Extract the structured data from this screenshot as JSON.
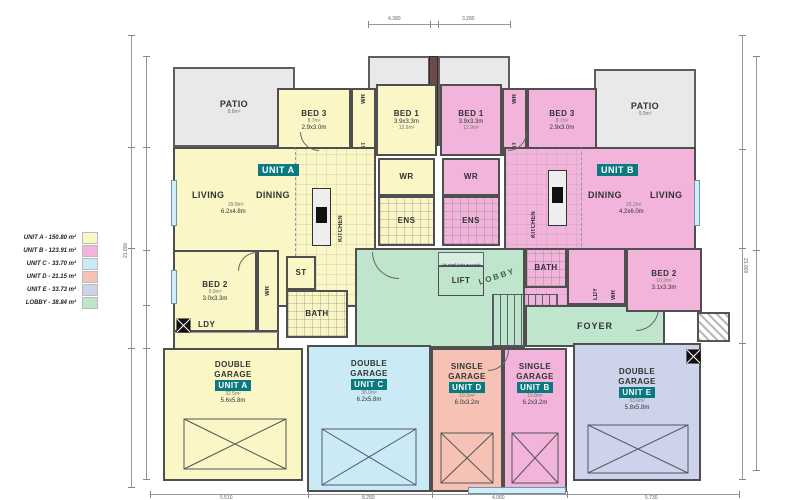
{
  "legend": {
    "items": [
      {
        "label": "UNIT A - 150.80 m²",
        "color": "#faf6c5"
      },
      {
        "label": "UNIT B - 123.91 m²",
        "color": "#f3b4dc"
      },
      {
        "label": "UNIT C - 33.70 m²",
        "color": "#caeaf6"
      },
      {
        "label": "UNIT D - 21.15 m²",
        "color": "#f6c2b6"
      },
      {
        "label": "UNIT E - 33.73 m²",
        "color": "#cdd3ea"
      },
      {
        "label": "LOBBY - 38.84 m²",
        "color": "#bfe5cc"
      }
    ]
  },
  "labels": {
    "patio": "PATIO",
    "wr": "WR",
    "st": "ST",
    "ens": "ENS",
    "bath": "BATH",
    "ldy": "LDY",
    "kitchen": "KITCHEN",
    "lift": "LIFT",
    "lobby": "LOBBY",
    "foyer": "FOYER"
  },
  "units": {
    "a": "UNIT A",
    "b": "UNIT B",
    "c": "UNIT C",
    "d": "UNIT D",
    "e": "UNIT E"
  },
  "rooms": {
    "bed3_a": {
      "name": "BED 3",
      "dim": "2.9x3.0m",
      "area": "8.7m²"
    },
    "bed1_a": {
      "name": "BED 1",
      "dim": "3.9x3.3m",
      "area": "12.9m²"
    },
    "bed1_b": {
      "name": "BED 1",
      "dim": "3.9x3.3m",
      "area": "12.9m²"
    },
    "bed3_b": {
      "name": "BED 3",
      "dim": "2.9x3.0m",
      "area": "8.7m²"
    },
    "living_a": {
      "l1": "LIVING",
      "l2": "DINING",
      "dim": "6.2x4.8m",
      "area": "29.8m²"
    },
    "living_b": {
      "l1": "DINING",
      "l2": "LIVING",
      "dim": "4.2x6.0m",
      "area": "25.2m²"
    },
    "bed2_a": {
      "name": "BED 2",
      "dim": "3.0x3.3m",
      "area": "9.9m²"
    },
    "bed2_b": {
      "name": "BED 2",
      "dim": "3.1x3.3m",
      "area": "10.2m²"
    },
    "lift_note": "Lift shaft light acoustic Passenger"
  },
  "patios": {
    "left": "8.8m²",
    "mid1": "6.8m²",
    "mid2": "6.8m²",
    "mid2_note": "16.750",
    "right": "9.0m²"
  },
  "garages": {
    "a": {
      "l1": "DOUBLE",
      "l2": "GARAGE",
      "dim": "5.6x5.8m",
      "area": "32.5m²"
    },
    "c": {
      "l1": "DOUBLE",
      "l2": "GARAGE",
      "dim": "6.2x5.8m",
      "area": "36.0m²"
    },
    "d": {
      "l1": "SINGLE",
      "l2": "GARAGE",
      "dim": "6.0x3.2m",
      "area": "19.2m²"
    },
    "b": {
      "l1": "SINGLE",
      "l2": "GARAGE",
      "dim": "6.2x3.2m",
      "area": "19.8m²"
    },
    "e": {
      "l1": "DOUBLE",
      "l2": "GARAGE",
      "dim": "5.8x5.8m",
      "area": "33.6m²"
    }
  },
  "dimensions": {
    "top1": "4.380",
    "top2": "3.280",
    "left_total": "21.800",
    "right_total": "21.800",
    "bottom": [
      "5.510",
      "8.280",
      "4.060",
      "5.730"
    ]
  }
}
